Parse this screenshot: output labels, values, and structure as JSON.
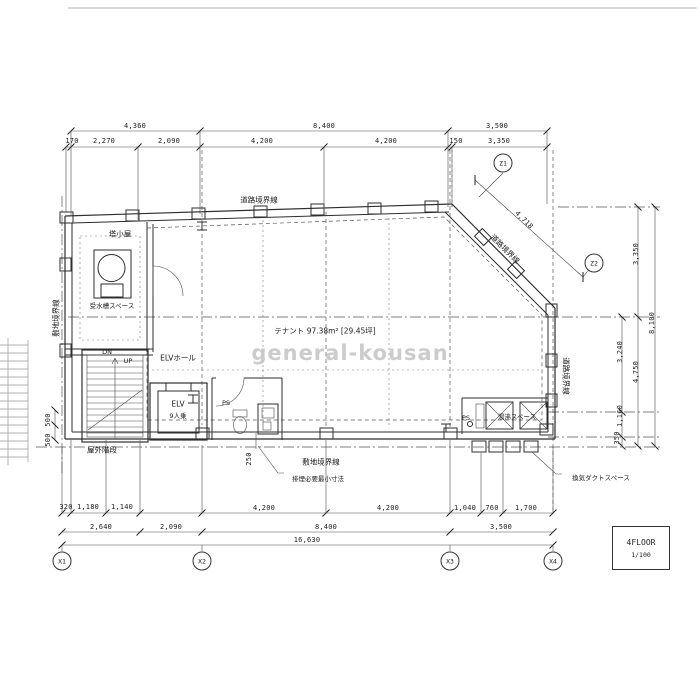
{
  "colors": {
    "paper": "#ffffff",
    "line": "#2e2e2e",
    "watermark": "#c4c4c4"
  },
  "watermark": "general-kousan",
  "title_block": {
    "floor": "4FLOOR",
    "scale": "1/100"
  },
  "axes": {
    "x1": "X1",
    "x2": "X2",
    "x3": "X3",
    "x4": "X4",
    "z1": "Z1",
    "z2": "Z2"
  },
  "boundaries": {
    "road_top": "道路境界線",
    "road_diagonal": "道路境界線",
    "road_right": "道路境界線",
    "site_left": "敷地境界線",
    "site_bottom": "敷地境界線"
  },
  "labels": {
    "penthouse": "塔小屋",
    "water_tank_space": "受水槽スペース",
    "elv_hall": "ELVホール",
    "elv": "ELV",
    "elv_capacity": "9人乗",
    "outdoor_stair": "屋外階段",
    "tenant_area": "テナント 97.38m² [29.45坪]",
    "down": "DN",
    "up": "UP",
    "pipe_space": "PS",
    "kitchenette": "湯沸スペース",
    "vent_duct_space": "換気ダクトスペース",
    "smoke_exhaust_min": "排煙必要最小寸法"
  },
  "dimensions": {
    "top_row1": [
      "4,360",
      "8,400",
      "3,500"
    ],
    "top_row2": [
      "170",
      "2,270",
      "2,090",
      "4,200",
      "4,200",
      "150",
      "3,350"
    ],
    "bottom_row1": [
      "320",
      "1,180",
      "1,140",
      "4,200",
      "4,200",
      "1,040",
      "760",
      "1,700"
    ],
    "bottom_row2": [
      "2,640",
      "2,090",
      "8,400",
      "3,500"
    ],
    "bottom_total": "16,630",
    "right_inner": [
      "3,240",
      "1,160",
      "350"
    ],
    "right_mid": [
      "3,350",
      "4,750"
    ],
    "right_total": "8,100",
    "diagonal": "4,718",
    "offset_smoke": "250",
    "offset_left_a": "500",
    "offset_left_b": "500"
  }
}
